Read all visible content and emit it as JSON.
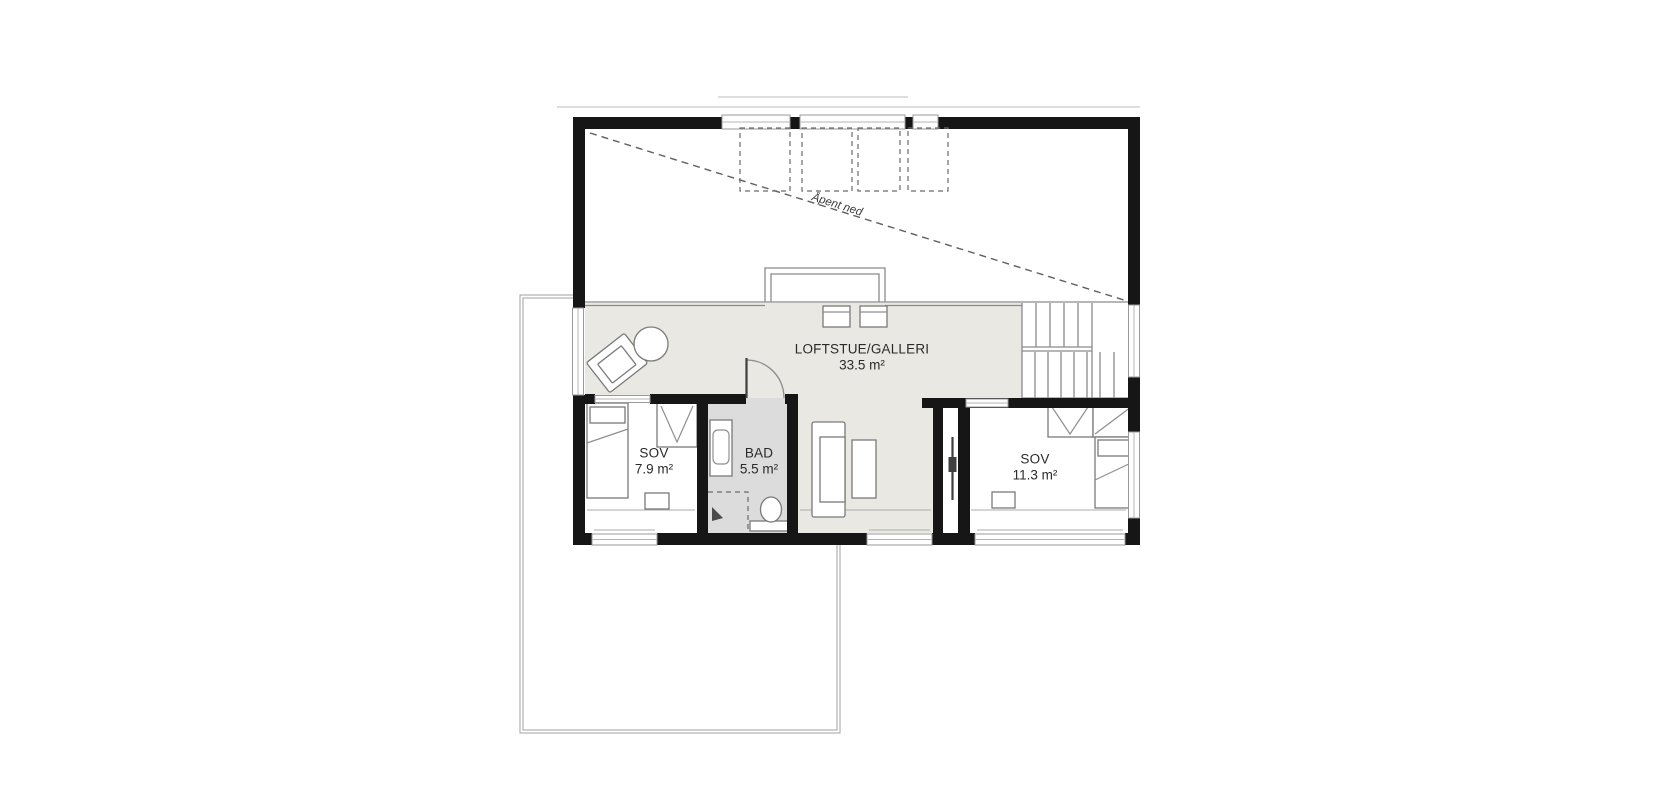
{
  "annotation": {
    "open_below": "Åpent ned"
  },
  "rooms": [
    {
      "name": "LOFTSTUE/GALLERI",
      "area": "33.5 m²"
    },
    {
      "name": "SOV",
      "area": "7.9 m²"
    },
    {
      "name": "BAD",
      "area": "5.5 m²"
    },
    {
      "name": "SOV",
      "area": "11.3 m²"
    }
  ],
  "colors": {
    "wall": "#161616",
    "loft_floor": "#e9e8e2",
    "bath_floor": "#dcdcdd",
    "furniture_line": "#7a7a7a",
    "window_line": "#9a9a9a",
    "dashed_line": "#5f5f5f",
    "lower_floor_outline": "#b0b0b0",
    "background": "#ffffff"
  }
}
